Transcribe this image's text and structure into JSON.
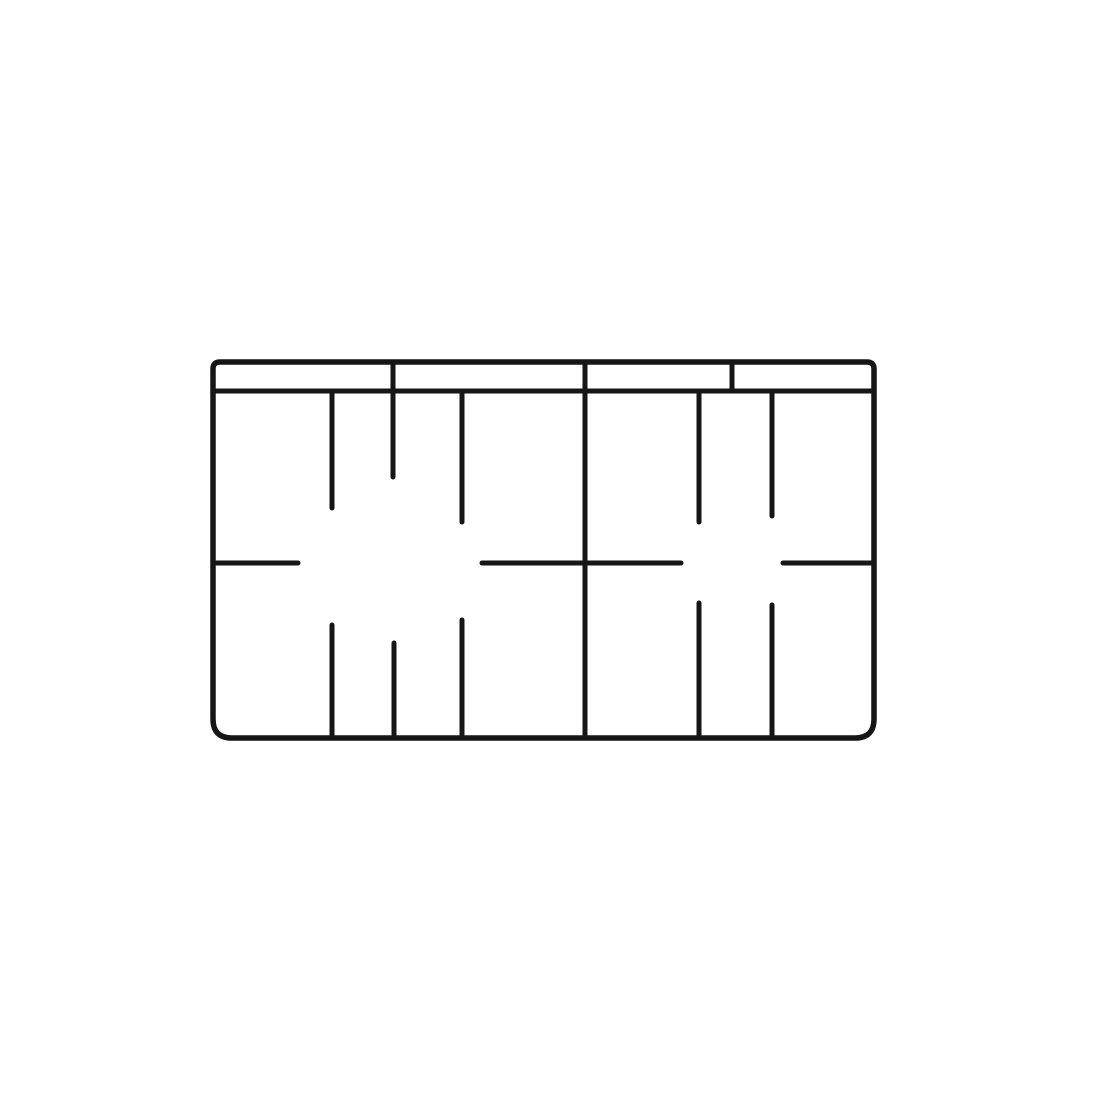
{
  "figure": {
    "title": "partition-grid-line-drawing",
    "background_color": "#ffffff",
    "stroke_color": "#161616",
    "frame_stroke_width": 5.5,
    "line_stroke_width": 5,
    "canvas": {
      "width": 1100,
      "height": 1100
    },
    "frame": {
      "x": 213,
      "y": 362,
      "width": 661,
      "height": 376,
      "radius_top": 7,
      "radius_bottom": 19
    },
    "segments": [
      {
        "name": "header-rail-line",
        "x1": 213,
        "y1": 391,
        "x2": 874,
        "y2": 391
      },
      {
        "name": "header-divider-left",
        "x1": 393,
        "y1": 362,
        "x2": 393,
        "y2": 477
      },
      {
        "name": "center-partition",
        "x1": 585,
        "y1": 362,
        "x2": 585,
        "y2": 738
      },
      {
        "name": "header-divider-right",
        "x1": 732,
        "y1": 362,
        "x2": 732,
        "y2": 391
      },
      {
        "name": "upper-slot-left-a",
        "x1": 332,
        "y1": 391,
        "x2": 332,
        "y2": 508
      },
      {
        "name": "upper-slot-left-b",
        "x1": 462,
        "y1": 391,
        "x2": 462,
        "y2": 522
      },
      {
        "name": "upper-slot-right-a",
        "x1": 699,
        "y1": 391,
        "x2": 699,
        "y2": 522
      },
      {
        "name": "upper-slot-right-b",
        "x1": 772,
        "y1": 391,
        "x2": 772,
        "y2": 516
      },
      {
        "name": "mid-shelf-left",
        "x1": 213,
        "y1": 563,
        "x2": 298,
        "y2": 563
      },
      {
        "name": "mid-shelf-center",
        "x1": 482,
        "y1": 563,
        "x2": 681,
        "y2": 563
      },
      {
        "name": "mid-shelf-right",
        "x1": 783,
        "y1": 563,
        "x2": 874,
        "y2": 563
      },
      {
        "name": "lower-slot-left-a",
        "x1": 332,
        "y1": 625,
        "x2": 332,
        "y2": 738
      },
      {
        "name": "lower-slot-left-b",
        "x1": 394,
        "y1": 643,
        "x2": 394,
        "y2": 738
      },
      {
        "name": "lower-slot-left-c",
        "x1": 462,
        "y1": 620,
        "x2": 462,
        "y2": 738
      },
      {
        "name": "lower-slot-right-a",
        "x1": 699,
        "y1": 603,
        "x2": 699,
        "y2": 738
      },
      {
        "name": "lower-slot-right-b",
        "x1": 772,
        "y1": 605,
        "x2": 772,
        "y2": 738
      }
    ]
  }
}
